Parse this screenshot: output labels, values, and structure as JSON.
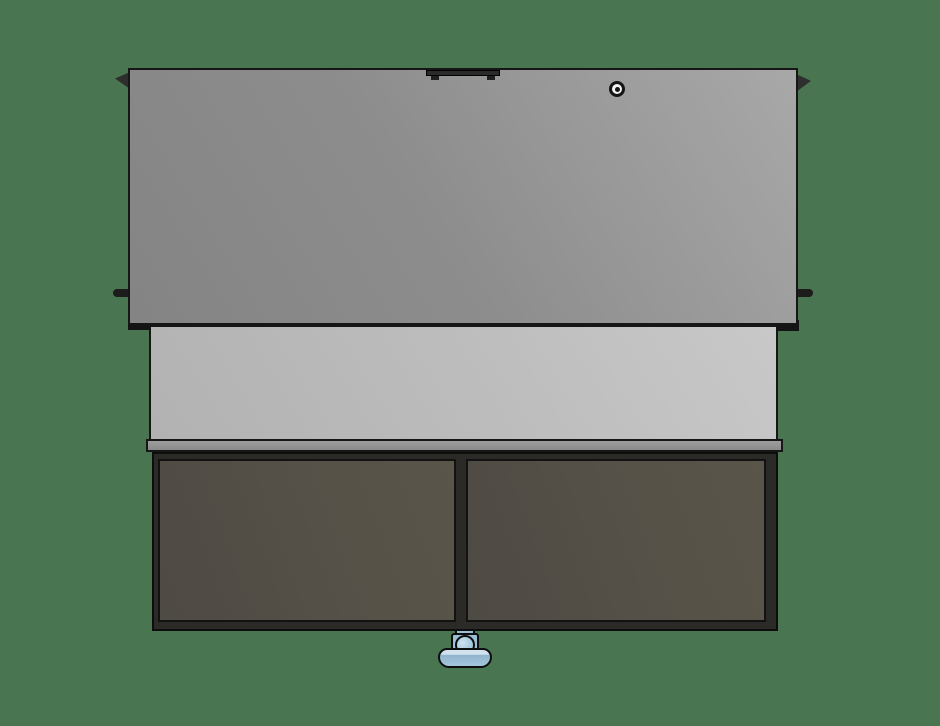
{
  "scene": {
    "view": "front-orthographic-render",
    "parts": {
      "lid_panel": "fold-down lid panel",
      "handle": "recessed pull handle",
      "lock": "lock cylinder",
      "hinge_bracket_left": "left hinge bracket",
      "hinge_bracket_right": "right hinge bracket",
      "pivot_pin_left": "left pivot pin",
      "pivot_pin_right": "right pivot pin",
      "back_panel": "inner back panel",
      "desktop_edge": "worktop front edge",
      "cabinet": "lower cabinet",
      "door_left": "left door panel",
      "door_right": "right door panel",
      "caster": "front swivel caster"
    }
  },
  "colors": {
    "background": "#497650",
    "outline": "#161616",
    "lid_dark": "#848484",
    "lid_light": "#a8a8a8",
    "back_panel_dark": "#b2b2b2",
    "back_panel_light": "#c8c8c8",
    "desktop_edge": "#8f8f8f",
    "cabinet_frame": "#2c2a27",
    "door_panel": "#55514a",
    "hardware_dark": "#2a2a2a",
    "pin_dark": "#1c1c1c",
    "lock_ring": "#f2f2f2",
    "lock_center": "#141414",
    "caster_light": "#cfe1ee",
    "caster_base": "#9dbfd6",
    "caster_shade": "#8fb4cc"
  }
}
